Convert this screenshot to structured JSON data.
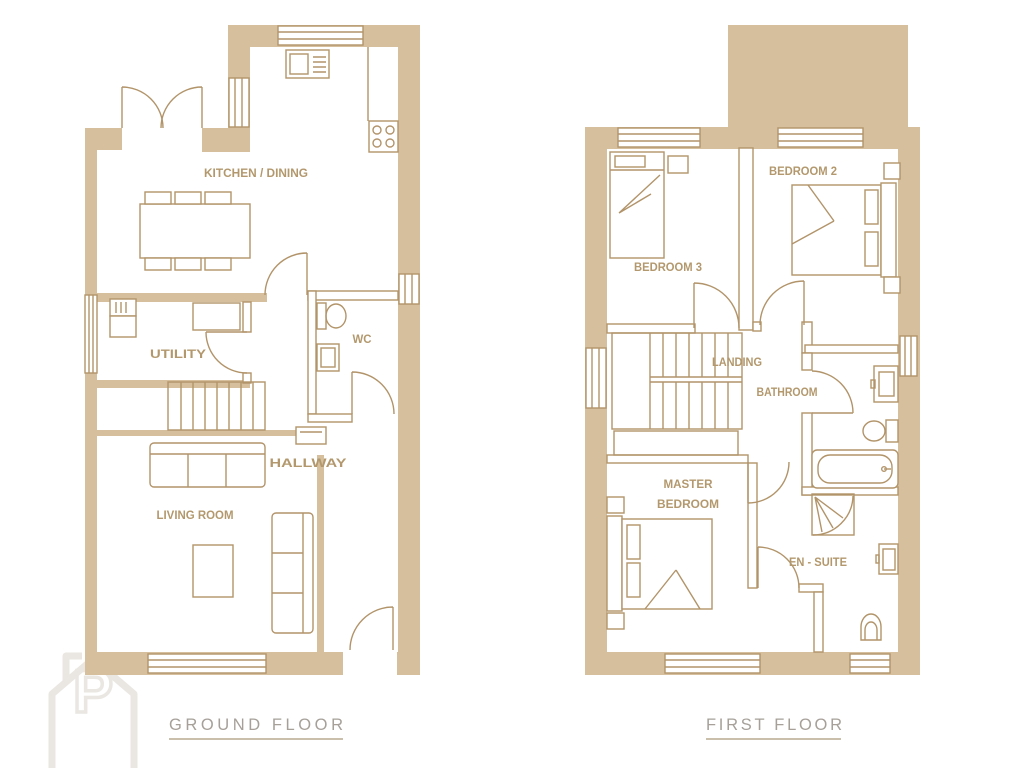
{
  "palette": {
    "wall": "#d5bf9d",
    "line": "#b2946a",
    "room_label": "#b3986d",
    "title": "#a6a099",
    "underline": "#b7aa8e",
    "watermark": "#eae7e2",
    "background": "#ffffff"
  },
  "ground_floor": {
    "title": "GROUND FLOOR",
    "rooms": {
      "kitchen_dining": "KITCHEN / DINING",
      "utility": "UTILITY",
      "wc": "WC",
      "hallway": "HALLWAY",
      "living_room": "LIVING ROOM"
    }
  },
  "first_floor": {
    "title": "FIRST FLOOR",
    "rooms": {
      "bedroom2": "BEDROOM 2",
      "bedroom3": "BEDROOM 3",
      "landing": "LANDING",
      "bathroom": "BATHROOM",
      "master_bedroom_line1": "MASTER",
      "master_bedroom_line2": "BEDROOM",
      "en_suite": "EN - SUITE"
    }
  },
  "watermark_letter": "P"
}
